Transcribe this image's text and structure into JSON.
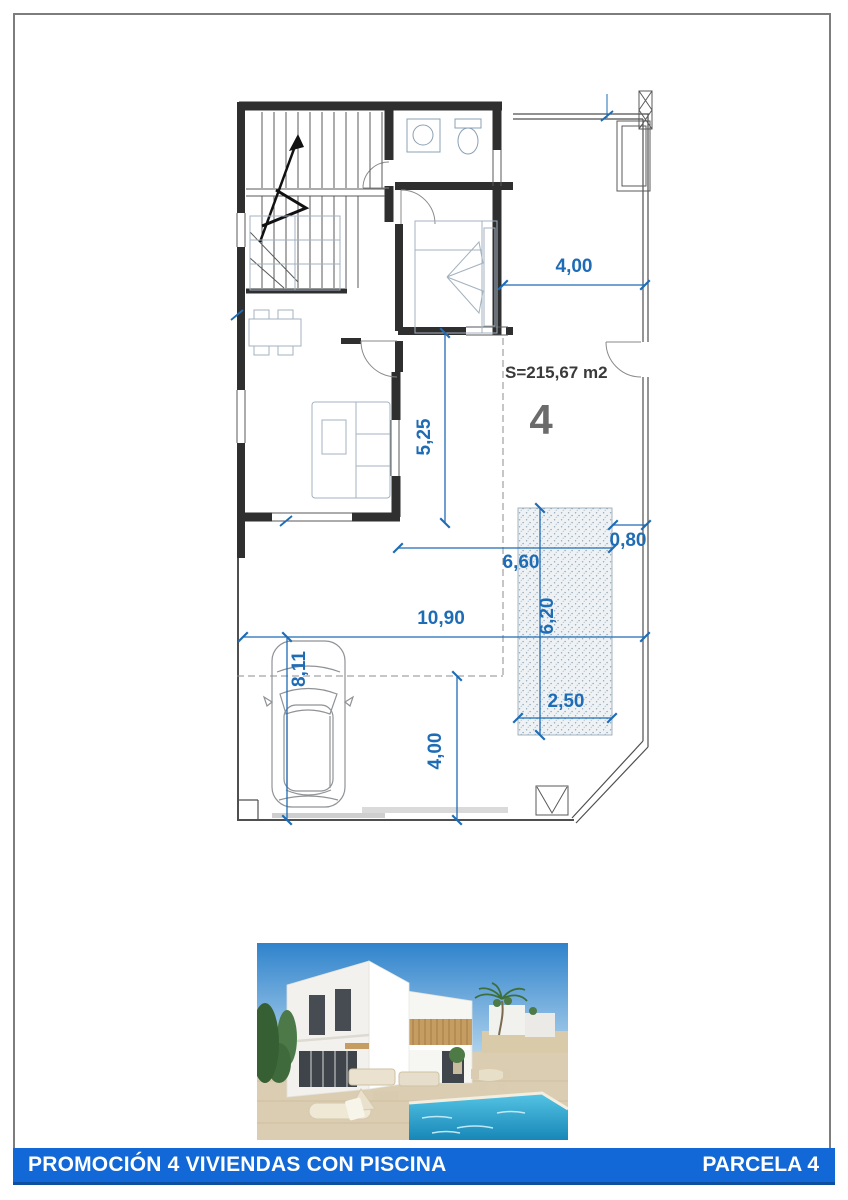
{
  "page": {
    "background": "#ffffff",
    "border_color": "#7d7d7d"
  },
  "plan": {
    "area_label": "S=215,67 m2",
    "unit_number": "4",
    "dimensions": {
      "plot_top_width": "4,00",
      "living_depth": "5,25",
      "pool_side_offset": "0,80",
      "terrace_width": "6,60",
      "pool_length": "6,20",
      "pool_width": "2,50",
      "plot_width": "10,90",
      "driveway_length": "8,11",
      "driveway_width": "4,00"
    },
    "colors": {
      "dimension_blue": "#1e6cb5",
      "wall_dark": "#2f2f2f",
      "furniture_gray": "#a3b2bf",
      "unit_number_gray": "#6b6b6b",
      "area_label_dark": "#3a3a3a"
    }
  },
  "photo": {
    "colors": {
      "sky_blue": "#3d8ed3",
      "villa_white": "#f2f1ed",
      "wood_accent": "#c59d63",
      "ground_sand": "#dbcdb1",
      "pool_turquoise": "#2fa9d4",
      "greenery": "#4c7947"
    }
  },
  "footer": {
    "left_text": "PROMOCIÓN 4 VIVIENDAS CON PISCINA",
    "right_text": "PARCELA 4",
    "bar_color": "#1168d6",
    "text_color": "#ffffff"
  }
}
